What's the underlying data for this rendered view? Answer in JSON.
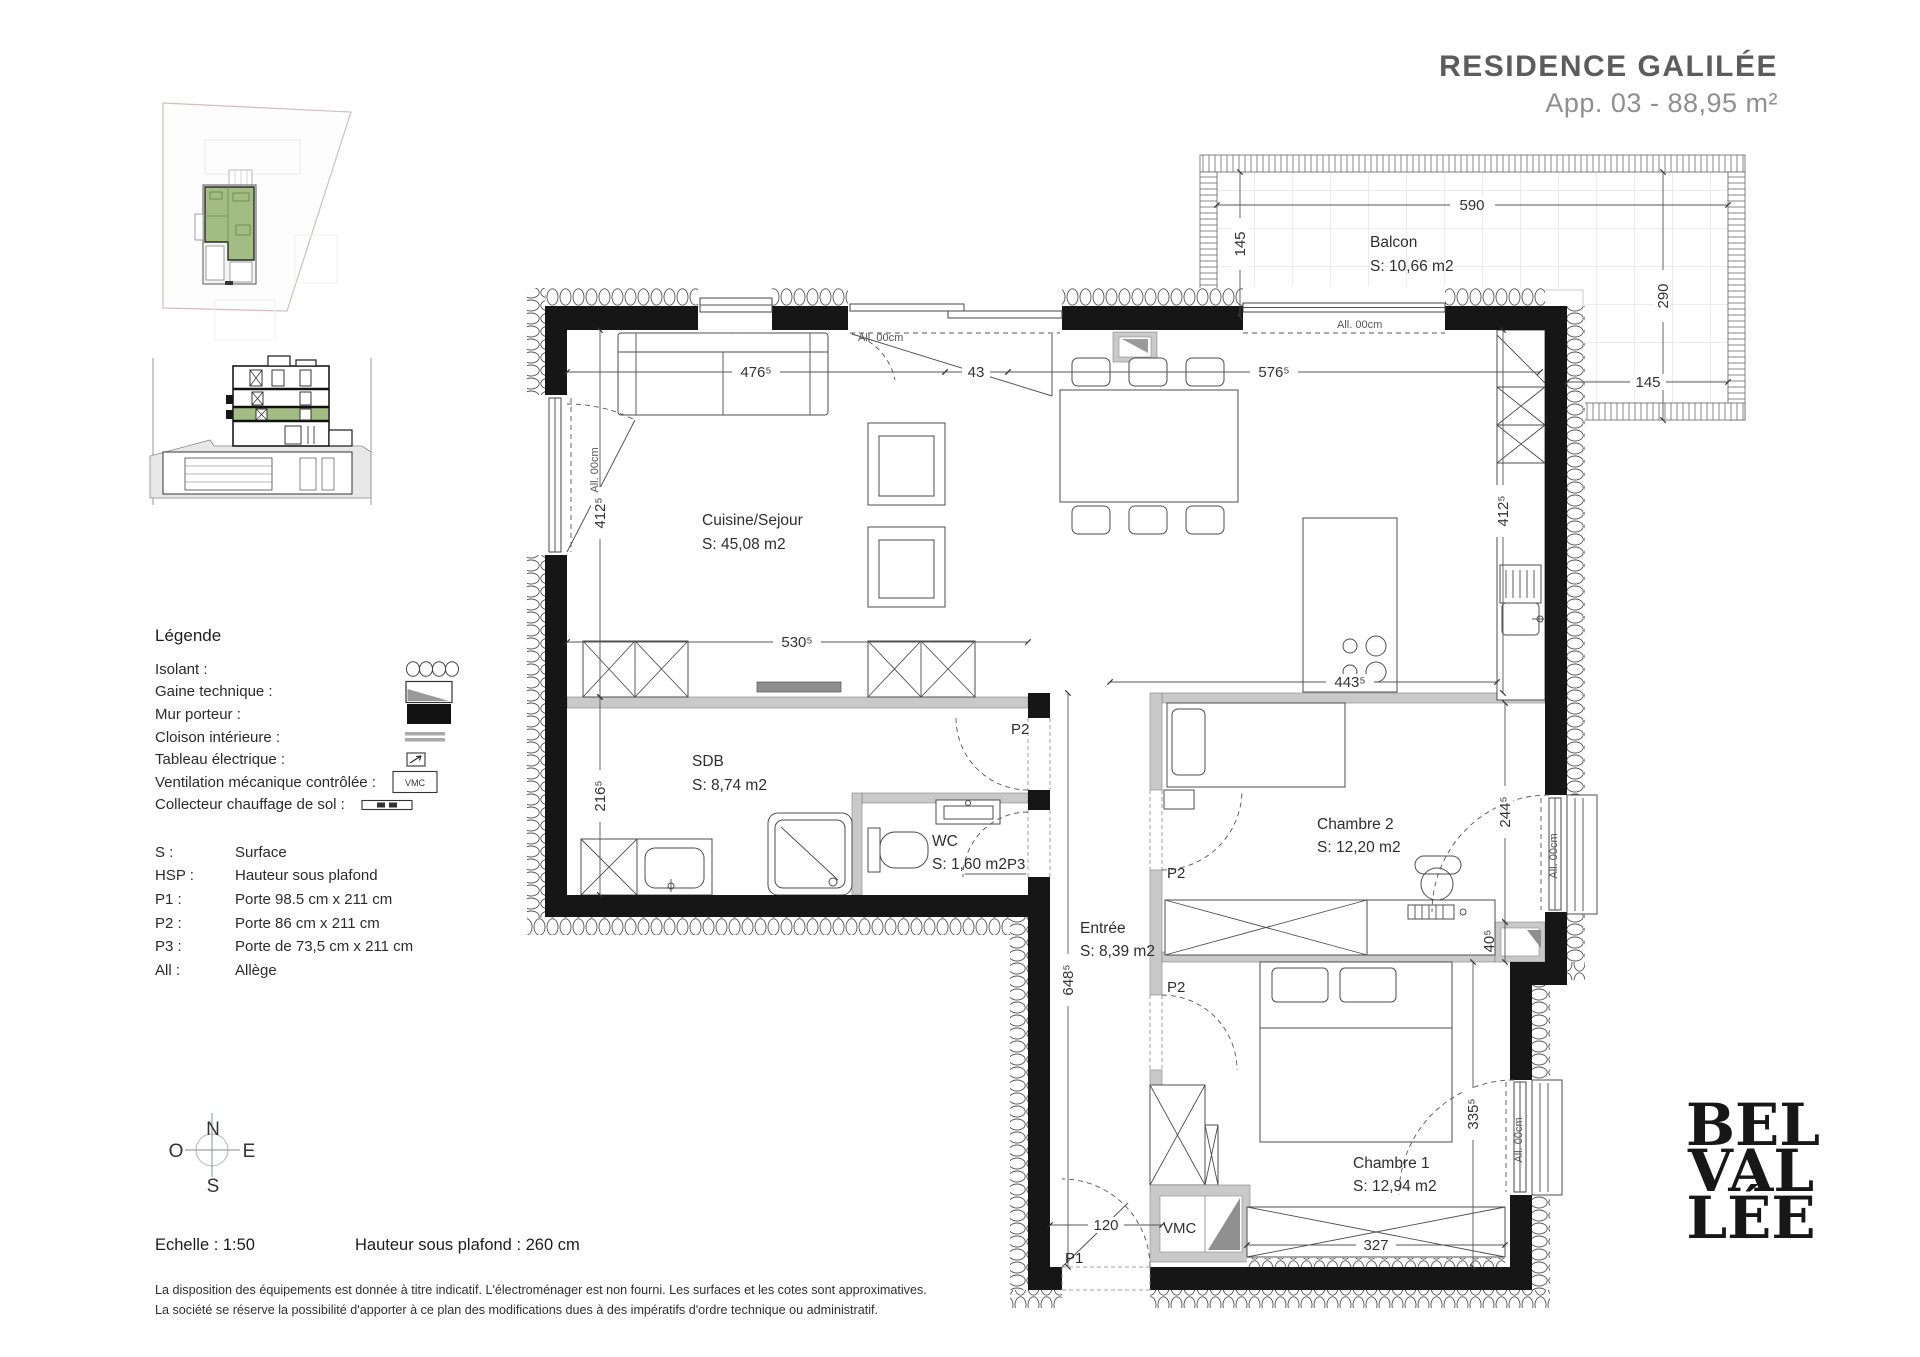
{
  "header": {
    "title": "RESIDENCE GALILÉE",
    "subtitle": "App. 03 - 88,95 m²"
  },
  "legend": {
    "title": "Légende",
    "items": [
      {
        "label": "Isolant :",
        "symbol": "insulation"
      },
      {
        "label": "Gaine technique :",
        "symbol": "technical-duct"
      },
      {
        "label": "Mur porteur :",
        "symbol": "load-bearing-wall"
      },
      {
        "label": "Cloison intérieure :",
        "symbol": "interior-partition"
      },
      {
        "label": "Tableau électrique :",
        "symbol": "electrical-panel"
      },
      {
        "label": "Ventilation mécanique contrôlée :",
        "symbol": "vmc-box"
      },
      {
        "label": "Collecteur chauffage de sol :",
        "symbol": "floor-heating-collector"
      }
    ],
    "vmc_text": "VMC",
    "abbreviations": [
      {
        "key": "S :",
        "value": "Surface"
      },
      {
        "key": "HSP :",
        "value": "Hauteur sous plafond"
      },
      {
        "key": "P1 :",
        "value": "Porte 98.5 cm x 211 cm"
      },
      {
        "key": "P2 :",
        "value": "Porte 86 cm x 211 cm"
      },
      {
        "key": "P3 :",
        "value": "Porte de 73,5 cm x 211 cm"
      },
      {
        "key": "All :",
        "value": "Allège"
      }
    ]
  },
  "compass": {
    "north": "N",
    "east": "E",
    "south": "S",
    "west": "O"
  },
  "footer": {
    "scale": "Echelle : 1:50",
    "ceiling_height": "Hauteur sous plafond : 260 cm",
    "disclaimer_line1": "La disposition des équipements est donnée à titre indicatif. L'électroménager est non fourni. Les surfaces et les cotes sont approximatives.",
    "disclaimer_line2": "La société se réserve la possibilité d'apporter à ce plan des modifications dues à des impératifs d'ordre technique ou administratif."
  },
  "logo": {
    "line1": "BEL",
    "line2": "VAL",
    "line3": "LÉE"
  },
  "plan": {
    "rooms": {
      "balcon": {
        "name": "Balcon",
        "surface": "S: 10,66 m2"
      },
      "cuisine": {
        "name": "Cuisine/Sejour",
        "surface": "S: 45,08 m2"
      },
      "sdb": {
        "name": "SDB",
        "surface": "S: 8,74 m2"
      },
      "wc": {
        "name": "WC",
        "surface": "S: 1,60 m2"
      },
      "entree": {
        "name": "Entrée",
        "surface": "S: 8,39 m2"
      },
      "chambre2": {
        "name": "Chambre 2",
        "surface": "S: 12,20 m2"
      },
      "chambre1": {
        "name": "Chambre 1",
        "surface": "S: 12,94 m2"
      }
    },
    "dims": {
      "balcony_width": "590",
      "balcony_depth_left": "145",
      "balcony_right": "290",
      "balcony_bottom": "145",
      "living_top_left": "476⁵",
      "duct_width": "43",
      "living_top_right": "576⁵",
      "living_left": "412⁵",
      "kitchen_right": "412⁵",
      "mid_wall": "530⁵",
      "sdb_left": "216⁵",
      "island": "443⁵",
      "entree_length": "648⁵",
      "chambre2_height": "244⁵",
      "shaft": "40⁵",
      "chambre1_height": "335⁵",
      "chambre1_width": "327",
      "entry_door_width": "120"
    },
    "doors": {
      "p1": "P1",
      "p2": "P2",
      "p3": "P3"
    },
    "window_sill": "All. 00cm",
    "vmc": "VMC"
  },
  "colors": {
    "wall": "#161616",
    "partition": "#c9c9c9",
    "highlight_green": "#a2bc83",
    "site_boundary": "#d8bcbc",
    "title_gray": "#5c5c5c"
  }
}
